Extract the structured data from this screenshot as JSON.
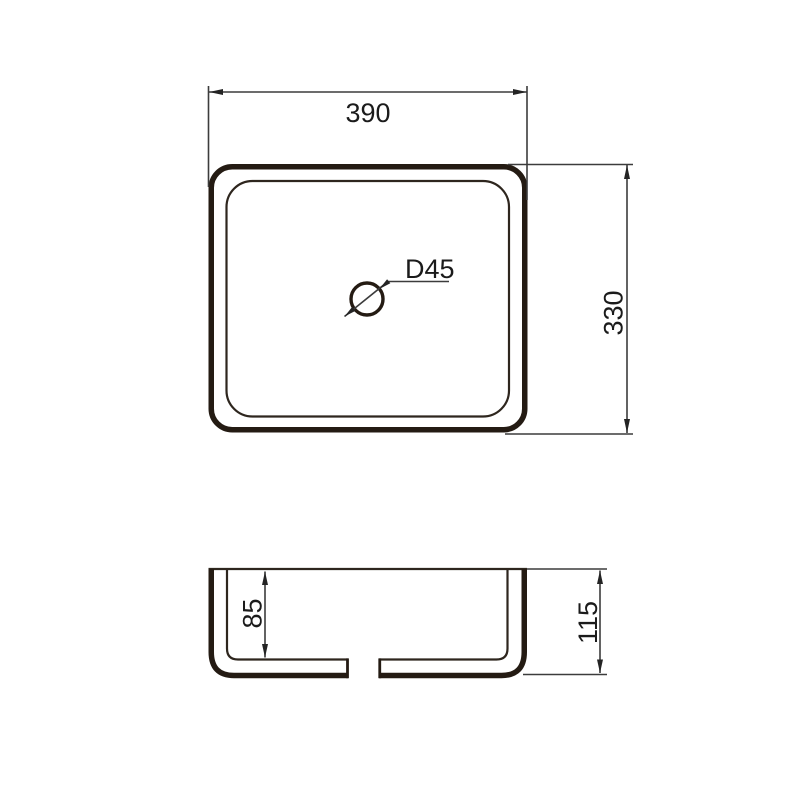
{
  "drawing": {
    "subject": "rectangular countertop wash basin dimension drawing",
    "background_color": "#ffffff",
    "outline_color": "#241b13",
    "dimension_line_color": "#3c3c3c",
    "text_color": "#1b1b1b",
    "top_view": {
      "width_dimension": "390",
      "depth_dimension": "330",
      "drain_diameter_label": "D45"
    },
    "section_view": {
      "inner_depth_dimension": "85",
      "overall_height_dimension": "115"
    }
  }
}
